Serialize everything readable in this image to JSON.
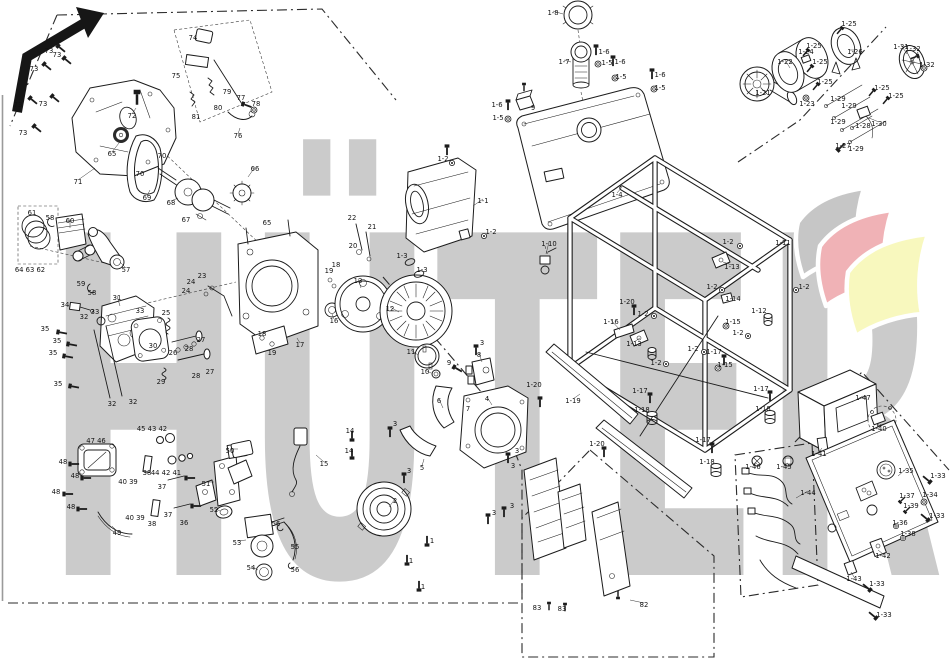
{
  "watermark": {
    "text": "HÜTER",
    "color": "#cbcbcb",
    "flag_colors": [
      "#c6c6c6",
      "#f0b2b6",
      "#f8f8be"
    ]
  },
  "diagram": {
    "background": "#ffffff",
    "line_color": "#1c1c1c",
    "type": "exploded-parts-diagram"
  },
  "icons": {
    "nav_arrow": "↖ bold bent arrow pointing up-right"
  },
  "labels": [
    {
      "t": "73",
      "x": 49,
      "y": 51
    },
    {
      "t": "73",
      "x": 57,
      "y": 55
    },
    {
      "t": "73",
      "x": 34,
      "y": 69
    },
    {
      "t": "73",
      "x": 18,
      "y": 105
    },
    {
      "t": "73",
      "x": 43,
      "y": 104
    },
    {
      "t": "73",
      "x": 23,
      "y": 133
    },
    {
      "t": "74",
      "x": 193,
      "y": 38
    },
    {
      "t": "75",
      "x": 176,
      "y": 76
    },
    {
      "t": "79",
      "x": 227,
      "y": 92
    },
    {
      "t": "80",
      "x": 218,
      "y": 108
    },
    {
      "t": "81",
      "x": 196,
      "y": 117
    },
    {
      "t": "77",
      "x": 241,
      "y": 98
    },
    {
      "t": "78",
      "x": 256,
      "y": 104
    },
    {
      "t": "76",
      "x": 238,
      "y": 136,
      "lx": 240,
      "ly": 128
    },
    {
      "t": "72",
      "x": 132,
      "y": 116,
      "lx": 136,
      "ly": 108
    },
    {
      "t": "71",
      "x": 78,
      "y": 182,
      "lx": 95,
      "ly": 168
    },
    {
      "t": "70",
      "x": 162,
      "y": 156
    },
    {
      "t": "70",
      "x": 140,
      "y": 174
    },
    {
      "t": "69",
      "x": 147,
      "y": 198,
      "lx": 150,
      "ly": 190
    },
    {
      "t": "68",
      "x": 171,
      "y": 203,
      "lx": 178,
      "ly": 198
    },
    {
      "t": "67",
      "x": 186,
      "y": 220
    },
    {
      "t": "66",
      "x": 255,
      "y": 169,
      "lx": 248,
      "ly": 177
    },
    {
      "t": "65",
      "x": 112,
      "y": 154,
      "lx": 119,
      "ly": 143
    },
    {
      "t": "65",
      "x": 267,
      "y": 223
    },
    {
      "t": "61",
      "x": 32,
      "y": 213
    },
    {
      "t": "58",
      "x": 50,
      "y": 218
    },
    {
      "t": "60",
      "x": 70,
      "y": 221,
      "lx": 70,
      "ly": 228
    },
    {
      "t": "64 63 62",
      "x": 30,
      "y": 270
    },
    {
      "t": "59",
      "x": 81,
      "y": 284
    },
    {
      "t": "58",
      "x": 92,
      "y": 293
    },
    {
      "t": "57",
      "x": 126,
      "y": 270,
      "lx": 120,
      "ly": 262
    },
    {
      "t": "34",
      "x": 65,
      "y": 305
    },
    {
      "t": "31",
      "x": 117,
      "y": 298,
      "lx": 120,
      "ly": 306
    },
    {
      "t": "33",
      "x": 95,
      "y": 312
    },
    {
      "t": "32",
      "x": 84,
      "y": 317
    },
    {
      "t": "33",
      "x": 140,
      "y": 311
    },
    {
      "t": "35",
      "x": 45,
      "y": 329
    },
    {
      "t": "35",
      "x": 57,
      "y": 341
    },
    {
      "t": "35",
      "x": 53,
      "y": 353
    },
    {
      "t": "35",
      "x": 58,
      "y": 384
    },
    {
      "t": "32",
      "x": 112,
      "y": 404
    },
    {
      "t": "32",
      "x": 133,
      "y": 402
    },
    {
      "t": "25",
      "x": 166,
      "y": 313
    },
    {
      "t": "30",
      "x": 153,
      "y": 346
    },
    {
      "t": "26",
      "x": 173,
      "y": 353
    },
    {
      "t": "28",
      "x": 189,
      "y": 349
    },
    {
      "t": "27",
      "x": 201,
      "y": 340
    },
    {
      "t": "28",
      "x": 196,
      "y": 376
    },
    {
      "t": "27",
      "x": 210,
      "y": 372
    },
    {
      "t": "29",
      "x": 161,
      "y": 382
    },
    {
      "t": "23",
      "x": 202,
      "y": 276
    },
    {
      "t": "24",
      "x": 191,
      "y": 282
    },
    {
      "t": "24",
      "x": 186,
      "y": 291
    },
    {
      "t": "18",
      "x": 262,
      "y": 334
    },
    {
      "t": "19",
      "x": 272,
      "y": 353
    },
    {
      "t": "17",
      "x": 300,
      "y": 345,
      "lx": 297,
      "ly": 338
    },
    {
      "t": "18",
      "x": 336,
      "y": 265
    },
    {
      "t": "19",
      "x": 329,
      "y": 271
    },
    {
      "t": "16",
      "x": 334,
      "y": 321,
      "lx": 332,
      "ly": 314
    },
    {
      "t": "22",
      "x": 352,
      "y": 218
    },
    {
      "t": "21",
      "x": 372,
      "y": 227
    },
    {
      "t": "20",
      "x": 353,
      "y": 246
    },
    {
      "t": "13",
      "x": 358,
      "y": 281,
      "lx": 361,
      "ly": 288
    },
    {
      "t": "12",
      "x": 390,
      "y": 309,
      "lx": 399,
      "ly": 312
    },
    {
      "t": "11",
      "x": 411,
      "y": 352,
      "lx": 418,
      "ly": 355
    },
    {
      "t": "10",
      "x": 425,
      "y": 372,
      "lx": 431,
      "ly": 373
    },
    {
      "t": "15",
      "x": 324,
      "y": 464,
      "lx": 316,
      "ly": 455
    },
    {
      "t": "14",
      "x": 350,
      "y": 431
    },
    {
      "t": "14",
      "x": 349,
      "y": 451
    },
    {
      "t": "45 43 42",
      "x": 152,
      "y": 429
    },
    {
      "t": "44 42 41",
      "x": 166,
      "y": 473
    },
    {
      "t": "40 39",
      "x": 128,
      "y": 482
    },
    {
      "t": "38",
      "x": 147,
      "y": 473
    },
    {
      "t": "37",
      "x": 162,
      "y": 487
    },
    {
      "t": "40 39",
      "x": 135,
      "y": 518
    },
    {
      "t": "38",
      "x": 152,
      "y": 524
    },
    {
      "t": "37",
      "x": 168,
      "y": 515
    },
    {
      "t": "36",
      "x": 184,
      "y": 523
    },
    {
      "t": "47 46",
      "x": 96,
      "y": 441
    },
    {
      "t": "48",
      "x": 63,
      "y": 462
    },
    {
      "t": "48",
      "x": 75,
      "y": 476
    },
    {
      "t": "48",
      "x": 56,
      "y": 492
    },
    {
      "t": "48",
      "x": 71,
      "y": 507
    },
    {
      "t": "49",
      "x": 117,
      "y": 533,
      "lx": 112,
      "ly": 526
    },
    {
      "t": "50",
      "x": 230,
      "y": 451,
      "lx": 238,
      "ly": 449
    },
    {
      "t": "51",
      "x": 206,
      "y": 484,
      "lx": 214,
      "ly": 482
    },
    {
      "t": "52",
      "x": 214,
      "y": 510,
      "lx": 220,
      "ly": 511
    },
    {
      "t": "53",
      "x": 237,
      "y": 543,
      "lx": 246,
      "ly": 540
    },
    {
      "t": "54",
      "x": 251,
      "y": 568,
      "lx": 258,
      "ly": 570
    },
    {
      "t": "55",
      "x": 295,
      "y": 547,
      "lx": 291,
      "ly": 547
    },
    {
      "t": "56",
      "x": 276,
      "y": 524
    },
    {
      "t": "56",
      "x": 295,
      "y": 570
    },
    {
      "t": "2",
      "x": 395,
      "y": 501,
      "lx": 389,
      "ly": 507
    },
    {
      "t": "1",
      "x": 432,
      "y": 541
    },
    {
      "t": "1",
      "x": 411,
      "y": 561
    },
    {
      "t": "1",
      "x": 423,
      "y": 587
    },
    {
      "t": "3",
      "x": 482,
      "y": 343
    },
    {
      "t": "3",
      "x": 395,
      "y": 424
    },
    {
      "t": "3",
      "x": 409,
      "y": 471
    },
    {
      "t": "3",
      "x": 517,
      "y": 451
    },
    {
      "t": "3",
      "x": 513,
      "y": 466
    },
    {
      "t": "3",
      "x": 512,
      "y": 506
    },
    {
      "t": "3",
      "x": 494,
      "y": 513
    },
    {
      "t": "5",
      "x": 422,
      "y": 468,
      "lx": 424,
      "ly": 459
    },
    {
      "t": "6",
      "x": 439,
      "y": 401,
      "lx": 443,
      "ly": 408
    },
    {
      "t": "7",
      "x": 468,
      "y": 409
    },
    {
      "t": "4",
      "x": 487,
      "y": 399,
      "lx": 492,
      "ly": 405
    },
    {
      "t": "8",
      "x": 479,
      "y": 355,
      "lx": 482,
      "ly": 362
    },
    {
      "t": "9",
      "x": 449,
      "y": 363
    },
    {
      "t": "83",
      "x": 537,
      "y": 608
    },
    {
      "t": "83",
      "x": 562,
      "y": 609
    },
    {
      "t": "82",
      "x": 644,
      "y": 605,
      "lx": 630,
      "ly": 600
    },
    {
      "t": "1-2",
      "x": 443,
      "y": 159
    },
    {
      "t": "1-1",
      "x": 483,
      "y": 201,
      "lx": 473,
      "ly": 206
    },
    {
      "t": "1-2",
      "x": 491,
      "y": 232
    },
    {
      "t": "1-3",
      "x": 402,
      "y": 256
    },
    {
      "t": "1-3",
      "x": 422,
      "y": 270
    },
    {
      "t": "1-10",
      "x": 549,
      "y": 244,
      "lx": 546,
      "ly": 254
    },
    {
      "t": "1-8",
      "x": 553,
      "y": 13,
      "lx": 563,
      "ly": 14
    },
    {
      "t": "1-7",
      "x": 564,
      "y": 62,
      "lx": 571,
      "ly": 62
    },
    {
      "t": "1-6",
      "x": 604,
      "y": 52
    },
    {
      "t": "1-5",
      "x": 607,
      "y": 63
    },
    {
      "t": "1-6",
      "x": 620,
      "y": 62
    },
    {
      "t": "1-5",
      "x": 621,
      "y": 77
    },
    {
      "t": "1-6",
      "x": 660,
      "y": 75
    },
    {
      "t": "1-5",
      "x": 660,
      "y": 88
    },
    {
      "t": "1-6",
      "x": 497,
      "y": 105
    },
    {
      "t": "1-5",
      "x": 498,
      "y": 118
    },
    {
      "t": "9",
      "x": 533,
      "y": 108
    },
    {
      "t": "1-4",
      "x": 617,
      "y": 195,
      "lx": 622,
      "ly": 187
    },
    {
      "t": "1-20",
      "x": 534,
      "y": 385
    },
    {
      "t": "1-11",
      "x": 783,
      "y": 243,
      "lx": 775,
      "ly": 248
    },
    {
      "t": "1-2",
      "x": 728,
      "y": 242
    },
    {
      "t": "1-2",
      "x": 712,
      "y": 287
    },
    {
      "t": "1-2",
      "x": 804,
      "y": 287
    },
    {
      "t": "1-2",
      "x": 643,
      "y": 314
    },
    {
      "t": "1-2",
      "x": 738,
      "y": 333
    },
    {
      "t": "1-2",
      "x": 693,
      "y": 349
    },
    {
      "t": "1-2",
      "x": 656,
      "y": 363
    },
    {
      "t": "1-13",
      "x": 732,
      "y": 267,
      "lx": 723,
      "ly": 262
    },
    {
      "t": "1-13",
      "x": 634,
      "y": 344,
      "lx": 640,
      "ly": 338
    },
    {
      "t": "1-14",
      "x": 733,
      "y": 299
    },
    {
      "t": "1-12",
      "x": 759,
      "y": 311
    },
    {
      "t": "1-15",
      "x": 733,
      "y": 322
    },
    {
      "t": "1-15",
      "x": 725,
      "y": 365
    },
    {
      "t": "1-16",
      "x": 611,
      "y": 322,
      "lx": 620,
      "ly": 330
    },
    {
      "t": "1-17",
      "x": 714,
      "y": 352
    },
    {
      "t": "1-17",
      "x": 640,
      "y": 391
    },
    {
      "t": "1-17",
      "x": 703,
      "y": 440
    },
    {
      "t": "1-17",
      "x": 761,
      "y": 389
    },
    {
      "t": "1-18",
      "x": 642,
      "y": 410
    },
    {
      "t": "1-18",
      "x": 707,
      "y": 462
    },
    {
      "t": "1-18",
      "x": 763,
      "y": 409
    },
    {
      "t": "1-19",
      "x": 573,
      "y": 401,
      "lx": 580,
      "ly": 394
    },
    {
      "t": "1-20",
      "x": 627,
      "y": 302
    },
    {
      "t": "1-20",
      "x": 597,
      "y": 444
    },
    {
      "t": "1-21",
      "x": 763,
      "y": 93,
      "lx": 760,
      "ly": 86
    },
    {
      "t": "1-22",
      "x": 785,
      "y": 62,
      "lx": 790,
      "ly": 68
    },
    {
      "t": "1-23",
      "x": 807,
      "y": 104
    },
    {
      "t": "1-24",
      "x": 806,
      "y": 52
    },
    {
      "t": "1-25",
      "x": 814,
      "y": 46
    },
    {
      "t": "1-25",
      "x": 820,
      "y": 62
    },
    {
      "t": "1-25",
      "x": 825,
      "y": 82
    },
    {
      "t": "1-25",
      "x": 849,
      "y": 24
    },
    {
      "t": "1-25",
      "x": 882,
      "y": 88
    },
    {
      "t": "1-25",
      "x": 896,
      "y": 96
    },
    {
      "t": "1-26",
      "x": 855,
      "y": 52,
      "lx": 850,
      "ly": 50
    },
    {
      "t": "1-27",
      "x": 843,
      "y": 146
    },
    {
      "t": "1-28",
      "x": 863,
      "y": 126
    },
    {
      "t": "1-29",
      "x": 838,
      "y": 99
    },
    {
      "t": "1-29",
      "x": 849,
      "y": 106
    },
    {
      "t": "1-29",
      "x": 838,
      "y": 122
    },
    {
      "t": "1-29",
      "x": 856,
      "y": 149
    },
    {
      "t": "1-30",
      "x": 879,
      "y": 124,
      "lx": 869,
      "ly": 118
    },
    {
      "t": "1-31",
      "x": 901,
      "y": 47,
      "lx": 907,
      "ly": 54
    },
    {
      "t": "1-32",
      "x": 913,
      "y": 49
    },
    {
      "t": "1-32",
      "x": 927,
      "y": 65
    },
    {
      "t": "1-47",
      "x": 863,
      "y": 398,
      "lx": 852,
      "ly": 402
    },
    {
      "t": "1-40",
      "x": 879,
      "y": 429,
      "lx": 881,
      "ly": 424
    },
    {
      "t": "1-41",
      "x": 819,
      "y": 454,
      "lx": 822,
      "ly": 448
    },
    {
      "t": "1-46",
      "x": 753,
      "y": 467,
      "lx": 757,
      "ly": 463
    },
    {
      "t": "1-45",
      "x": 784,
      "y": 467,
      "lx": 788,
      "ly": 463
    },
    {
      "t": "1-44",
      "x": 808,
      "y": 493,
      "lx": 796,
      "ly": 498
    },
    {
      "t": "1-35",
      "x": 906,
      "y": 471,
      "lx": 898,
      "ly": 476
    },
    {
      "t": "1-34",
      "x": 930,
      "y": 495
    },
    {
      "t": "1-37",
      "x": 907,
      "y": 496
    },
    {
      "t": "1-39",
      "x": 911,
      "y": 506
    },
    {
      "t": "1-36",
      "x": 900,
      "y": 523
    },
    {
      "t": "1-38",
      "x": 908,
      "y": 534
    },
    {
      "t": "1-42",
      "x": 883,
      "y": 556,
      "lx": 878,
      "ly": 550
    },
    {
      "t": "1-43",
      "x": 854,
      "y": 579,
      "lx": 851,
      "ly": 572
    },
    {
      "t": "1-33",
      "x": 938,
      "y": 476
    },
    {
      "t": "1-33",
      "x": 937,
      "y": 516
    },
    {
      "t": "1-33",
      "x": 877,
      "y": 584
    },
    {
      "t": "1-33",
      "x": 884,
      "y": 615
    }
  ]
}
